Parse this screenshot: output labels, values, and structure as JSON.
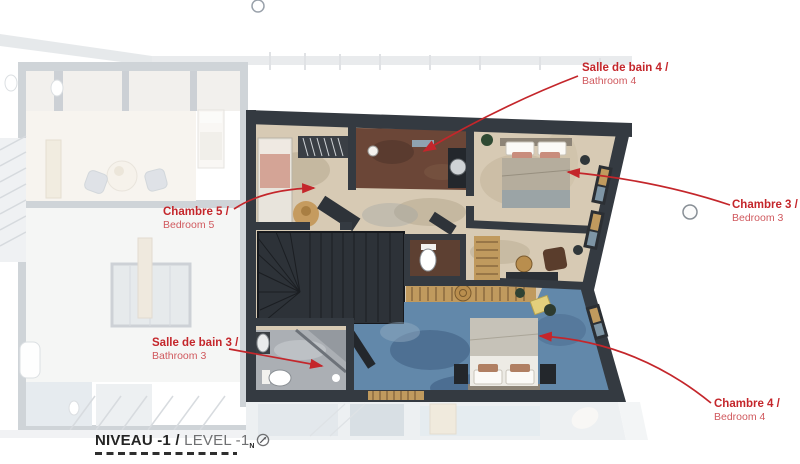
{
  "title": {
    "fr": "NIVEAU -1 /",
    "en": "LEVEL -1",
    "north_sub": "N"
  },
  "annotations": {
    "bathroom4": {
      "fr": "Salle de bain 4 /",
      "en": "Bathroom 4"
    },
    "bedroom5": {
      "fr": "Chambre 5 /",
      "en": "Bedroom 5"
    },
    "bedroom3": {
      "fr": "Chambre 3 /",
      "en": "Bedroom 3"
    },
    "bathroom3": {
      "fr": "Salle de bain 3 /",
      "en": "Bathroom 3"
    },
    "bedroom4": {
      "fr": "Chambre 4 /",
      "en": "Bedroom 4"
    }
  },
  "icons": {
    "north_arrow": "north-arrow-icon",
    "marker_top": "marker-circle-icon",
    "marker_right": "marker-circle-icon"
  },
  "colors": {
    "red": "#c4262b",
    "redlight": "#d0595e",
    "ink": "#242424",
    "graytxt": "#6f7072",
    "wall": "#343a41",
    "beige": "#d7cab4",
    "brown": "#6b4637",
    "blue": "#6288aa",
    "graybath": "#abafb4",
    "stairs": "#2d3238",
    "wood": "#c09a5e"
  }
}
